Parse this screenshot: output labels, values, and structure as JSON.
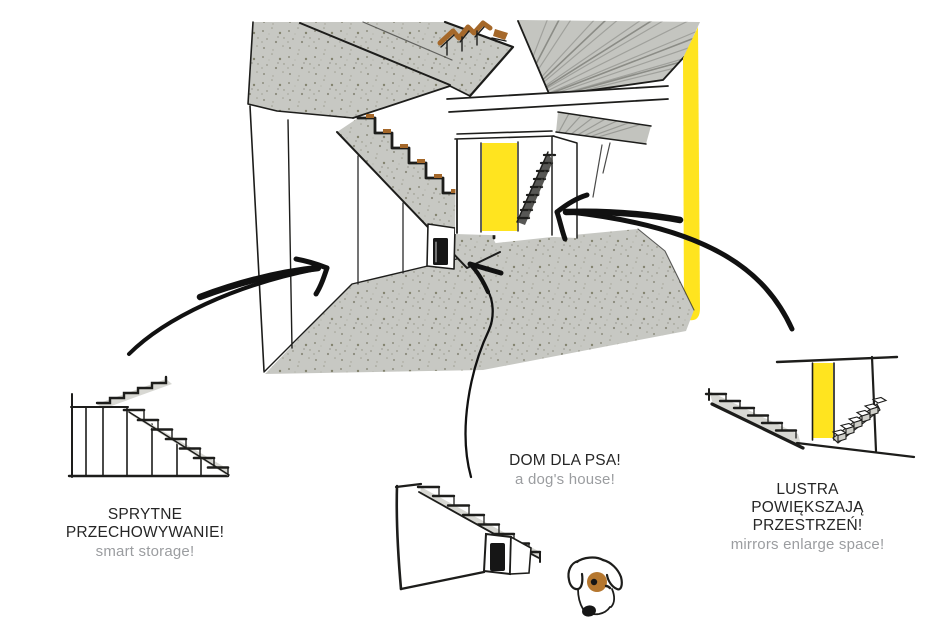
{
  "colors": {
    "accent_yellow": "#ffe41f",
    "wood_brown": "#a5682a",
    "concrete_gray": "#c7c8c3",
    "ink_black": "#1d1d1b",
    "caption_black": "#262626",
    "caption_gray": "#9b9da0",
    "dog_patch_brown": "#b5772f"
  },
  "captions": {
    "storage": {
      "line1": "SPRYTNE",
      "line2": "PRZECHOWYWANIE!",
      "subtitle": "smart storage!"
    },
    "dog_house": {
      "line1": "DOM DLA PSA!",
      "subtitle": "a dog's house!"
    },
    "mirrors": {
      "line1": "LUSTRA",
      "line2": "POWIĘKSZAJĄ",
      "line3": "PRZESTRZEŃ!",
      "subtitle": "mirrors enlarge space!"
    }
  },
  "figures": {
    "main_sketch": "interior-hallway-staircase-sketch",
    "storage_sketch": "under-stair-storage-sketch",
    "dog_house_sketch": "under-stair-dog-house-sketch",
    "dog_sketch": "dog-head-sketch",
    "mirror_sketch": "mirror-staircase-sketch"
  }
}
